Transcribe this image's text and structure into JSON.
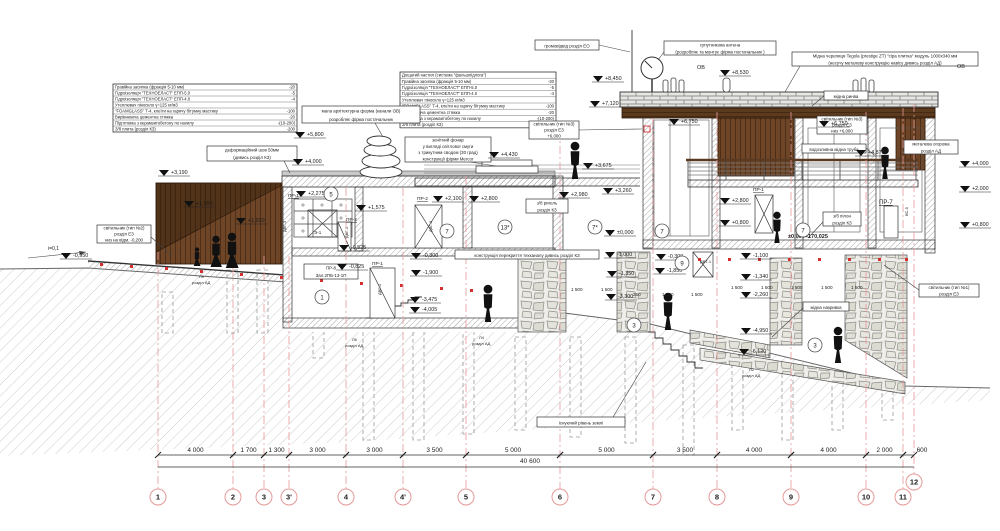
{
  "title": "Розріз 2-2",
  "colors": {
    "line": "#2a2a2a",
    "hatch": "#8f8f8f",
    "ground_hatch": "#cdcdcd",
    "wood_dark": "#4a2c14",
    "wood": "#6e4526",
    "red_accent": "#cc2020",
    "grid_pink": "#e59999",
    "stone": "#8f8f88"
  },
  "spec_tables": [
    {
      "name": "roof-spec-left",
      "x": 113,
      "y": 84,
      "w": 184,
      "rh": 6,
      "fs": 4.2,
      "rows": [
        [
          "Гравійна засипка (фракція 5-10 мм)",
          "-20"
        ],
        [
          "Гідроізоляція \"ТЕХНОЕЛАСТ\" ЕПП-5.0",
          "-5"
        ],
        [
          "Гідроізоляція \"ТЕХНОЕЛАСТ\" ЕПП-4.0",
          "-4"
        ],
        [
          "Утеплювач піноскло γ=125 кг/м3",
          ""
        ],
        [
          "\"FOAMGLASS\" Т-4, клеїти на гарячу бітумну мастику",
          "-100"
        ],
        [
          "Вирівнююча цементна стяжка",
          "-20"
        ],
        [
          "Підготовка з керамзитобетону по нахилу",
          "-(10-200)"
        ],
        [
          "З/б плита (розділ КЗ)",
          "-200"
        ]
      ]
    },
    {
      "name": "roof-spec-center",
      "x": 400,
      "y": 72,
      "w": 156,
      "rh": 6.2,
      "fs": 4.2,
      "rows": [
        [
          "Дощатий настил (система \"фальшпідлога\")",
          ""
        ],
        [
          "Гравійна засипка (фракція 5-10 мм)",
          "-20"
        ],
        [
          "Гідроізоляція \"ТЕХНОЕЛАСТ\" ЕПП-5.0",
          "-5"
        ],
        [
          "Гідроізоляція \"ТЕХНОЕЛАСТ\" ЕПП-4.0",
          "-4"
        ],
        [
          "Утеплювач піноскло γ=125 кг/м3",
          ""
        ],
        [
          "\"FOAMGLASS\" Т-4, клеїти на гарячу бітумну мастику",
          "-100"
        ],
        [
          "Вирівнююча цементна стяжка",
          "-20"
        ],
        [
          "Підготовка з керамзитобетону по нахилу",
          "-(10-200)"
        ],
        [
          "З/б плита (розділ КЗ)",
          "-200"
        ]
      ]
    }
  ],
  "callouts": [
    {
      "x": 302,
      "y": 106,
      "w": 118,
      "h": 17,
      "lines": [
        "мала архітектурна форма (канали ОВ)",
        "розробляє фірма постачальник"
      ],
      "leader": [
        375,
        123,
        383,
        137
      ]
    },
    {
      "x": 207,
      "y": 146,
      "w": 90,
      "h": 15,
      "lines": [
        "деформаційний шов 50мм",
        "(дивись розділ КЗ)"
      ],
      "leader": [
        284,
        161,
        290,
        173
      ]
    },
    {
      "x": 405,
      "y": 137,
      "w": 86,
      "h": 25,
      "lines": [
        "зенітний фонар",
        "у вигляді світлової смуги",
        "з трикутним сводом (30 град)",
        "конструкції фірми Mercor"
      ],
      "leader": [
        470,
        162,
        496,
        166
      ]
    },
    {
      "x": 535,
      "y": 40,
      "w": 64,
      "h": 10,
      "lines": [
        "громовідвід розділ ЕО"
      ],
      "leader": [
        599,
        45,
        630,
        52
      ]
    },
    {
      "x": 664,
      "y": 41,
      "w": 112,
      "h": 14,
      "lines": [
        "супутникова антена",
        "(розробляє та монтує фірма постачальник )"
      ],
      "leader": [
        664,
        52,
        658,
        60
      ]
    },
    {
      "x": 792,
      "y": 52,
      "w": 186,
      "h": 14,
      "lines": [
        "Мідна черепиця Tegola (prestige ZT) \"сіра плитка\" модуль 1000х340 мм",
        "(несучу металеву конструкцію навісу дивись розділ АД)"
      ],
      "leader": [
        800,
        66,
        785,
        92
      ]
    },
    {
      "x": 824,
      "y": 91,
      "w": 44,
      "h": 9,
      "lines": [
        "мідна ринва"
      ],
      "leader": [
        824,
        96,
        812,
        106
      ]
    },
    {
      "x": 817,
      "y": 116,
      "w": 50,
      "h": 18,
      "lines": [
        "світильник (тип №3)",
        "розділ ЕЗ",
        "низ +6,000"
      ]
    },
    {
      "x": 529,
      "y": 121,
      "w": 50,
      "h": 18,
      "lines": [
        "світильник (тип №3)",
        "розділ ЕЗ",
        "+6,000"
      ],
      "leader": [
        579,
        130,
        642,
        129
      ]
    },
    {
      "x": 802,
      "y": 144,
      "w": 64,
      "h": 9,
      "lines": [
        "водозливна мідна труба"
      ],
      "leader": [
        866,
        148,
        874,
        155
      ]
    },
    {
      "x": 904,
      "y": 140,
      "w": 54,
      "h": 14,
      "lines": [
        "металева огорожа",
        "розділ АД"
      ],
      "leader": [
        904,
        150,
        896,
        162
      ]
    },
    {
      "x": 97,
      "y": 225,
      "w": 54,
      "h": 18,
      "lines": [
        "світильник (тип №2)",
        "розділ ЕЗ",
        "низ на відм. -0,200"
      ],
      "leader": [
        151,
        237,
        172,
        256
      ]
    },
    {
      "x": 526,
      "y": 199,
      "w": 42,
      "h": 14,
      "lines": [
        "з/б ригель",
        "розділ КЗ"
      ]
    },
    {
      "x": 823,
      "y": 212,
      "w": 38,
      "h": 14,
      "lines": [
        "з/б пілон",
        "розділ КЗ"
      ],
      "leader": [
        823,
        222,
        808,
        238
      ]
    },
    {
      "x": 304,
      "y": 264,
      "w": 54,
      "h": 15,
      "lines": [
        "ПР-8",
        "Зал.2ПБ-13-1П"
      ]
    },
    {
      "x": 803,
      "y": 302,
      "w": 46,
      "h": 9,
      "lines": [
        "мідна накривка"
      ],
      "leader": [
        803,
        308,
        772,
        337
      ]
    },
    {
      "x": 919,
      "y": 284,
      "w": 60,
      "h": 13,
      "lines": [
        "світильник (тип №1)",
        "розділ ЕЗ"
      ],
      "leader": [
        919,
        290,
        884,
        265
      ]
    },
    {
      "x": 455,
      "y": 250,
      "w": 144,
      "h": 9,
      "lines": [
        "конструкція перекриття техканалу дивись розділ КЗ"
      ]
    },
    {
      "x": 537,
      "y": 417,
      "w": 88,
      "h": 10,
      "lines": [
        "існуючий рівень землі"
      ],
      "leader": [
        613,
        417,
        646,
        362
      ]
    }
  ],
  "elevations": [
    {
      "v": "-0,950",
      "x": 62,
      "y": 259
    },
    {
      "v": "+3,190",
      "x": 160,
      "y": 176
    },
    {
      "v": "+1,900",
      "x": 185,
      "y": 207
    },
    {
      "v": "+1,920",
      "x": 237,
      "y": 224
    },
    {
      "v": "+5,800",
      "x": 296,
      "y": 138
    },
    {
      "v": "+4,000",
      "x": 294,
      "y": 165
    },
    {
      "v": "+2,275",
      "x": 297,
      "y": 197
    },
    {
      "v": "+1,575",
      "x": 357,
      "y": 211
    },
    {
      "v": "-0,525",
      "x": 340,
      "y": 251
    },
    {
      "v": "-0,825",
      "x": 338,
      "y": 270
    },
    {
      "v": "+2,100",
      "x": 434,
      "y": 202
    },
    {
      "v": "+2,800",
      "x": 470,
      "y": 202
    },
    {
      "v": "-0,300",
      "x": 412,
      "y": 259
    },
    {
      "v": "-1,900",
      "x": 412,
      "y": 276
    },
    {
      "v": "-3,475",
      "x": 411,
      "y": 303
    },
    {
      "v": "-4,005",
      "x": 411,
      "y": 313
    },
    {
      "v": "+2,980",
      "x": 560,
      "y": 198
    },
    {
      "v": "+3,260",
      "x": 604,
      "y": 194
    },
    {
      "v": "±0,000",
      "x": 606,
      "y": 236
    },
    {
      "v": "-1,000",
      "x": 606,
      "y": 258
    },
    {
      "v": "-1,350",
      "x": 608,
      "y": 277
    },
    {
      "v": "-3,300",
      "x": 607,
      "y": 300
    },
    {
      "v": "+4,430",
      "x": 490,
      "y": 158
    },
    {
      "v": "+3,675",
      "x": 584,
      "y": 169
    },
    {
      "v": "+8,450",
      "x": 594,
      "y": 82
    },
    {
      "v": "+7,120",
      "x": 591,
      "y": 107
    },
    {
      "v": "+8,530",
      "x": 721,
      "y": 76
    },
    {
      "v": "+6,750",
      "x": 670,
      "y": 125
    },
    {
      "v": "+6,750",
      "x": 820,
      "y": 127
    },
    {
      "v": "+2,800",
      "x": 721,
      "y": 204
    },
    {
      "v": "+0,800",
      "x": 721,
      "y": 226
    },
    {
      "v": "-0,300",
      "x": 657,
      "y": 260
    },
    {
      "v": "-1,850",
      "x": 656,
      "y": 274
    },
    {
      "v": "-1,100",
      "x": 742,
      "y": 259
    },
    {
      "v": "-1,340",
      "x": 742,
      "y": 280
    },
    {
      "v": "-2,260",
      "x": 742,
      "y": 298
    },
    {
      "v": "-4,950",
      "x": 742,
      "y": 334
    },
    {
      "v": "-6,120",
      "x": 740,
      "y": 355
    },
    {
      "v": "+4,870",
      "x": 857,
      "y": 156
    },
    {
      "v": "+4,000",
      "x": 961,
      "y": 167
    },
    {
      "v": "+2,000",
      "x": 961,
      "y": 192
    },
    {
      "v": "+0,800",
      "x": 961,
      "y": 228
    }
  ],
  "labels": [
    {
      "t": "ОВ",
      "x": 697,
      "y": 69,
      "s": 5.5
    },
    {
      "t": "ОВ",
      "x": 957,
      "y": 68,
      "s": 5.5
    },
    {
      "t": "ПР-1",
      "x": 288,
      "y": 197,
      "s": 4.8,
      "u": 1
    },
    {
      "t": "ПР-2",
      "x": 346,
      "y": 221,
      "s": 4.8,
      "u": 1
    },
    {
      "t": "ПР-2",
      "x": 417,
      "y": 200,
      "s": 4.8,
      "u": 1
    },
    {
      "t": "ПР-1",
      "x": 372,
      "y": 265,
      "s": 4.8,
      "u": 1
    },
    {
      "t": "ПР-1",
      "x": 753,
      "y": 191,
      "s": 4.8,
      "u": 1
    },
    {
      "t": "ПР-7",
      "x": 879,
      "y": 204,
      "s": 6,
      "u": 1
    },
    {
      "t": "Э-1",
      "x": 314,
      "y": 234,
      "s": 4.5
    },
    {
      "t": "ДВТ-1",
      "x": 700,
      "y": 263,
      "s": 4
    },
    {
      "t": "ДВГ-3",
      "x": 286,
      "y": 232,
      "s": 4,
      "r": -90
    },
    {
      "t": "ДВГ-1",
      "x": 348,
      "y": 238,
      "s": 4,
      "r": -90
    },
    {
      "t": "ДВГ-3",
      "x": 432,
      "y": 232,
      "s": 4,
      "r": -90
    },
    {
      "t": "ДВГ-1",
      "x": 381,
      "y": 295,
      "s": 4,
      "r": -90
    },
    {
      "t": "ВС-5",
      "x": 908,
      "y": 216,
      "s": 4,
      "r": -90
    },
    {
      "t": "Л9",
      "x": 199,
      "y": 278,
      "s": 4
    },
    {
      "t": "розділ АД",
      "x": 192,
      "y": 284,
      "s": 4
    },
    {
      "t": "Л6",
      "x": 352,
      "y": 341,
      "s": 4
    },
    {
      "t": "розділ АД",
      "x": 345,
      "y": 347,
      "s": 4
    },
    {
      "t": "Л4",
      "x": 479,
      "y": 339,
      "s": 4
    },
    {
      "t": "розділ АД",
      "x": 472,
      "y": 345,
      "s": 4
    },
    {
      "t": "Л2",
      "x": 749,
      "y": 371,
      "s": 4
    },
    {
      "t": "розділ АД",
      "x": 742,
      "y": 377,
      "s": 4
    },
    {
      "t": "і=0,1",
      "x": 48,
      "y": 250,
      "s": 5
    },
    {
      "t": "±0,000=170,025",
      "x": 788,
      "y": 238,
      "s": 5.5,
      "c": "#cc2020",
      "b": 1
    }
  ],
  "refs": [
    {
      "n": "5",
      "x": 331,
      "y": 194
    },
    {
      "n": "7",
      "x": 447,
      "y": 231
    },
    {
      "n": "13*",
      "x": 505,
      "y": 227
    },
    {
      "n": "7*",
      "x": 595,
      "y": 227
    },
    {
      "n": "7",
      "x": 662,
      "y": 231
    },
    {
      "n": "9",
      "x": 682,
      "y": 263
    },
    {
      "n": "7",
      "x": 803,
      "y": 230
    },
    {
      "n": "1",
      "x": 322,
      "y": 297
    },
    {
      "n": "3",
      "x": 634,
      "y": 325
    },
    {
      "n": "3",
      "x": 815,
      "y": 345
    }
  ],
  "inner_dims": [
    {
      "t": "1 500",
      "x": 571,
      "y": 291
    },
    {
      "t": "1 500",
      "x": 601,
      "y": 291
    },
    {
      "t": "250",
      "x": 633,
      "y": 296
    },
    {
      "t": "1 500",
      "x": 662,
      "y": 296
    },
    {
      "t": "1 500",
      "x": 691,
      "y": 296
    },
    {
      "t": "1 500",
      "x": 731,
      "y": 289
    },
    {
      "t": "1 500",
      "x": 761,
      "y": 289
    },
    {
      "t": "1 500",
      "x": 791,
      "y": 289
    },
    {
      "t": "1 500",
      "x": 821,
      "y": 289
    },
    {
      "t": "1 500",
      "x": 851,
      "y": 289
    }
  ],
  "grid": {
    "dim_line_y": 455,
    "total_line_y": 467,
    "bubble_y": 497,
    "bubble_r": 8,
    "total": {
      "label": "40 600",
      "x": 530,
      "y": 463
    },
    "bubbles": [
      {
        "n": "1",
        "x": 158,
        "top": 252
      },
      {
        "n": "2",
        "x": 233,
        "top": 252
      },
      {
        "n": "3",
        "x": 264,
        "top": 256
      },
      {
        "n": "3'",
        "x": 289,
        "top": 256
      },
      {
        "n": "4",
        "x": 346,
        "top": 188
      },
      {
        "n": "4'",
        "x": 403,
        "top": 188
      },
      {
        "n": "5",
        "x": 466,
        "top": 176
      },
      {
        "n": "6",
        "x": 560,
        "top": 130
      },
      {
        "n": "7",
        "x": 653,
        "top": 118
      },
      {
        "n": "8",
        "x": 717,
        "top": 112
      },
      {
        "n": "9",
        "x": 791,
        "top": 112
      },
      {
        "n": "10",
        "x": 866,
        "top": 112
      },
      {
        "n": "11",
        "x": 903,
        "top": 108
      },
      {
        "n": "12",
        "x": 914,
        "top": 104,
        "cy": 482
      }
    ],
    "dims": [
      {
        "label": "4 000",
        "x1": 158,
        "x2": 233
      },
      {
        "label": "1 700",
        "x1": 233,
        "x2": 264
      },
      {
        "label": "1 300",
        "x1": 264,
        "x2": 289
      },
      {
        "label": "3 000",
        "x1": 289,
        "x2": 346
      },
      {
        "label": "3 000",
        "x1": 346,
        "x2": 403
      },
      {
        "label": "3 500",
        "x1": 403,
        "x2": 466
      },
      {
        "label": "5 000",
        "x1": 466,
        "x2": 560
      },
      {
        "label": "5 000",
        "x1": 560,
        "x2": 653
      },
      {
        "label": "3 500",
        "x1": 653,
        "x2": 717
      },
      {
        "label": "4 000",
        "x1": 717,
        "x2": 791
      },
      {
        "label": "4 000",
        "x1": 791,
        "x2": 866
      },
      {
        "label": "2 000",
        "x1": 866,
        "x2": 903
      },
      {
        "label": "600",
        "x1": 903,
        "x2": 914,
        "lx": 922
      }
    ]
  },
  "figures": [
    {
      "x": 197,
      "y": 266,
      "h": 19,
      "t": "walk"
    },
    {
      "x": 216,
      "y": 267,
      "h": 32,
      "t": "walk"
    },
    {
      "x": 232,
      "y": 268,
      "h": 36,
      "t": "walk"
    },
    {
      "x": 575,
      "y": 179,
      "h": 38,
      "t": "stand"
    },
    {
      "x": 488,
      "y": 322,
      "h": 38,
      "t": "stand"
    },
    {
      "x": 668,
      "y": 330,
      "h": 38,
      "t": "stand"
    },
    {
      "x": 777,
      "y": 243,
      "h": 32,
      "t": "stand"
    },
    {
      "x": 885,
      "y": 179,
      "h": 33,
      "t": "stand"
    },
    {
      "x": 838,
      "y": 363,
      "h": 37,
      "t": "stand"
    }
  ]
}
